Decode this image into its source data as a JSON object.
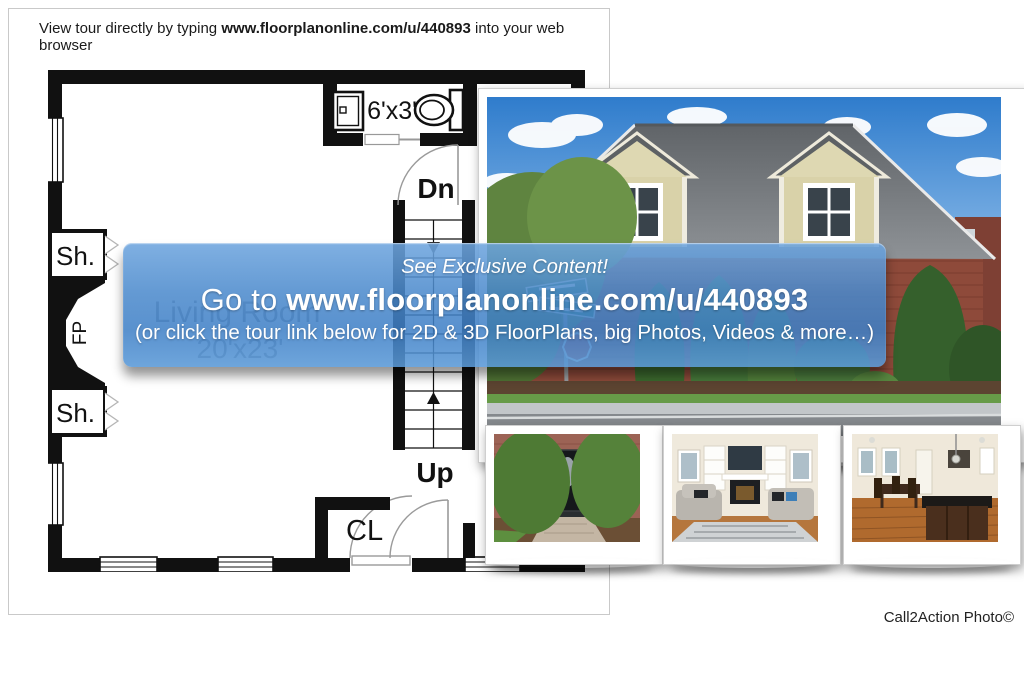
{
  "header": {
    "prefix": "View tour directly by typing ",
    "url": "www.floorplanonline.com/u/440893",
    "suffix": " into your web browser"
  },
  "banner": {
    "line1": "See Exclusive Content!",
    "line2_prefix": "Go to ",
    "line2_url": "www.floorplanonline.com/u/440893",
    "line3": "(or click the tour link below for 2D & 3D FloorPlans, big Photos, Videos & more…)",
    "color_top": "#6ea5de",
    "color_bottom": "#3e7fc6"
  },
  "floorplan": {
    "room_name": "Living Room",
    "room_dim": "20'x23'",
    "bath_dim": "6'x3'",
    "stairs_down": "Dn",
    "stairs_up": "Up",
    "closet": "CL",
    "shelf_top": "Sh.",
    "shelf_bottom": "Sh.",
    "fireplace": "FP",
    "wall_color": "#111111"
  },
  "photos": {
    "main": "house exterior front with dormers",
    "thumbnails": [
      "front door entry",
      "living room with fireplace",
      "kitchen and dining area"
    ]
  },
  "credit": "Call2Action Photo©"
}
